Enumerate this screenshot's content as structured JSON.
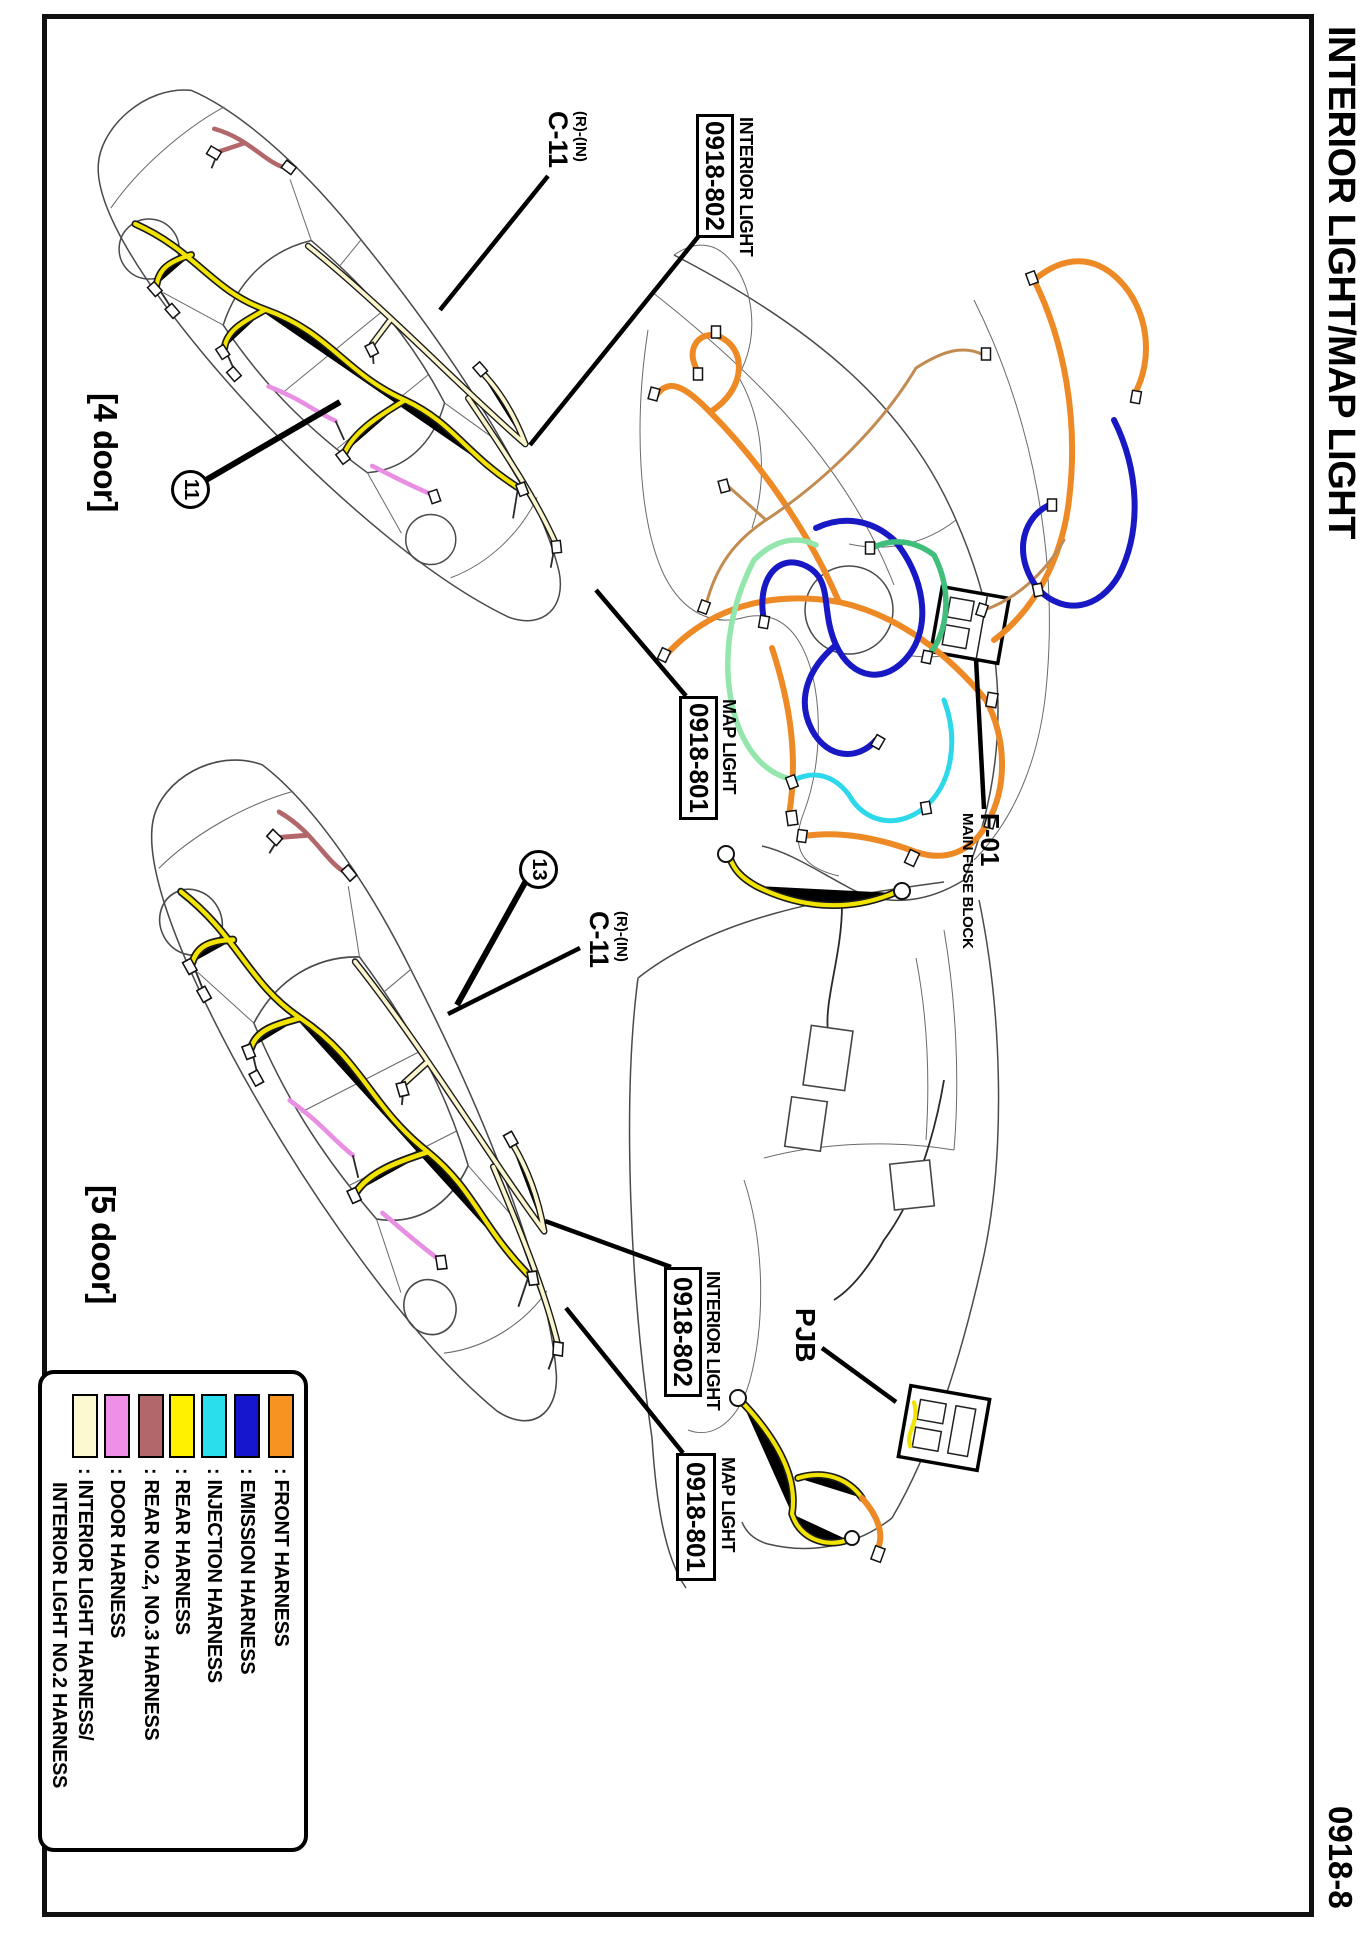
{
  "page": {
    "title": "INTERIOR LIGHT/MAP LIGHT",
    "page_number": "0918-8"
  },
  "four_door": {
    "label": "[4 door]",
    "clip_number": "11",
    "connector": {
      "position": "(R)-(IN)",
      "code": "C-11"
    },
    "interior_light": {
      "name": "INTERIOR LIGHT",
      "code": "0918-802"
    },
    "map_light": {
      "name": "MAP LIGHT",
      "code": "0918-801"
    }
  },
  "five_door": {
    "label": "[5 door]",
    "clip_number": "13",
    "connector": {
      "position": "(R)-(IN)",
      "code": "C-11"
    },
    "interior_light": {
      "name": "INTERIOR LIGHT",
      "code": "0918-802"
    },
    "map_light": {
      "name": "MAP LIGHT",
      "code": "0918-801"
    }
  },
  "engine_bay": {
    "fuse_block_code": "F-01",
    "fuse_block_name": "MAIN FUSE BLOCK"
  },
  "interior": {
    "pjb_label": "PJB"
  },
  "legend": {
    "colon": ":",
    "items": [
      {
        "name": "front-harness",
        "color": "#F79421",
        "label": "FRONT HARNESS"
      },
      {
        "name": "emission-harness",
        "color": "#1616CE",
        "label": "EMISSION HARNESS"
      },
      {
        "name": "injection-harness",
        "color": "#2BDEEC",
        "label": "INJECTION HARNESS"
      },
      {
        "name": "rear-harness",
        "color": "#FFF100",
        "label": "REAR HARNESS"
      },
      {
        "name": "rear-no2-no3-harness",
        "color": "#B2686B",
        "label": "REAR NO.2, NO.3 HARNESS"
      },
      {
        "name": "door-harness",
        "color": "#EE8FE8",
        "label": "DOOR HARNESS"
      },
      {
        "name": "interior-light-harness",
        "color": "#FCF8CF",
        "label": "INTERIOR LIGHT HARNESS/",
        "label2": "INTERIOR LIGHT NO.2 HARNESS"
      }
    ]
  }
}
